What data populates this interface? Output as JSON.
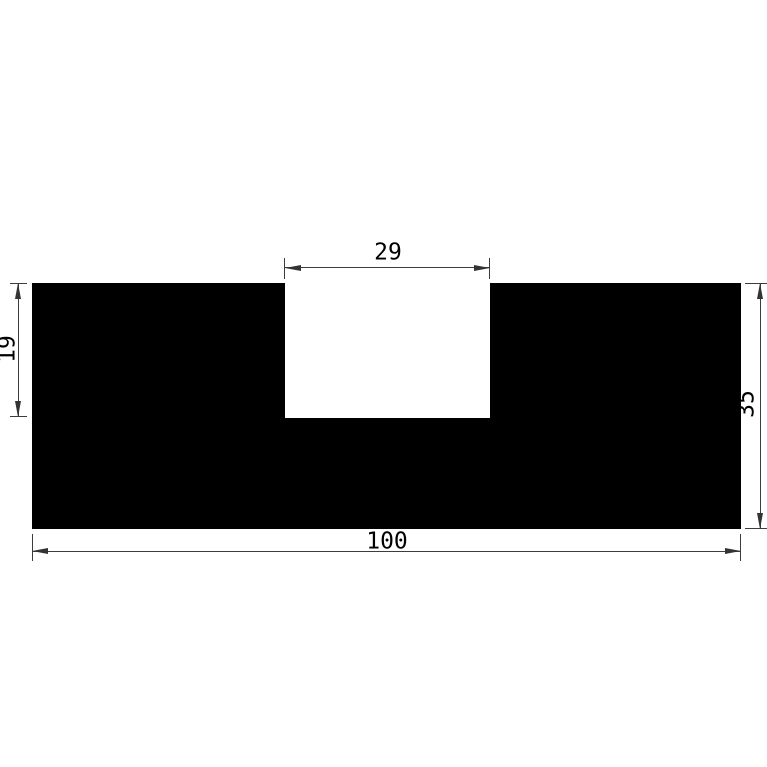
{
  "drawing": {
    "kind": "profile-cross-section-technical-drawing",
    "dimensions": {
      "notch_width": "29",
      "notch_depth": "19",
      "profile_height": "35",
      "profile_width": "100"
    },
    "colors": {
      "profile_fill": "#000000",
      "background": "#ffffff",
      "dimension_line": "#3c3c3c",
      "arrow": "#333333",
      "text": "#000000"
    }
  }
}
